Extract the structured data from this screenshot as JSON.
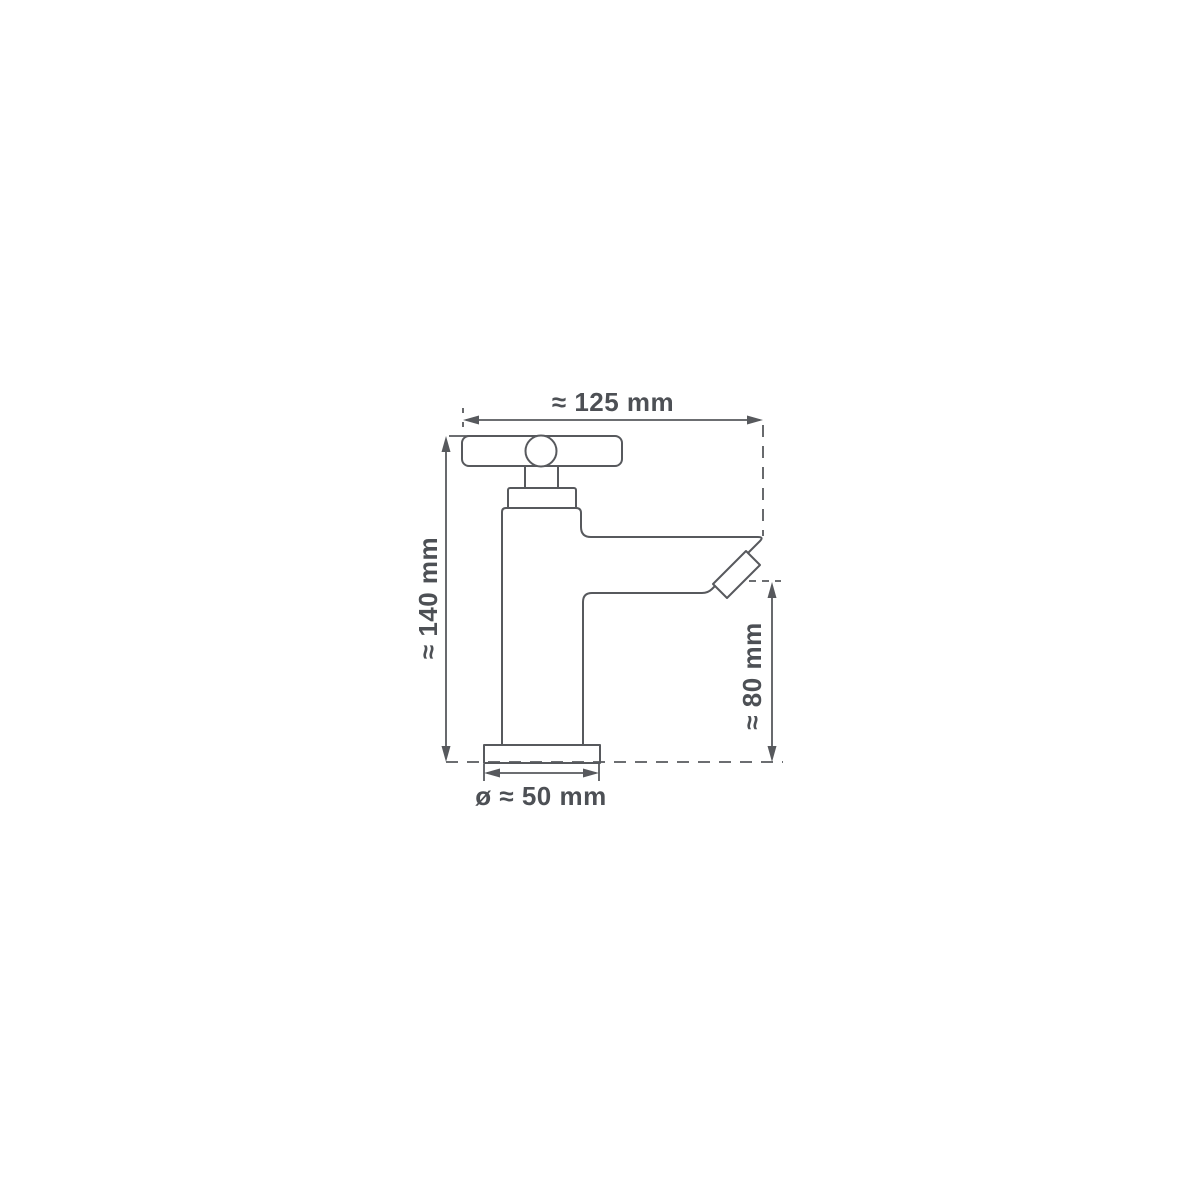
{
  "diagram": {
    "labels": {
      "width": "≈ 125 mm",
      "height": "≈ 140 mm",
      "spout_height": "≈ 80 mm",
      "base_diameter": "ø ≈ 50 mm"
    },
    "colors": {
      "line": "#57595d",
      "text": "#4d5055",
      "background": "#ffffff"
    }
  }
}
